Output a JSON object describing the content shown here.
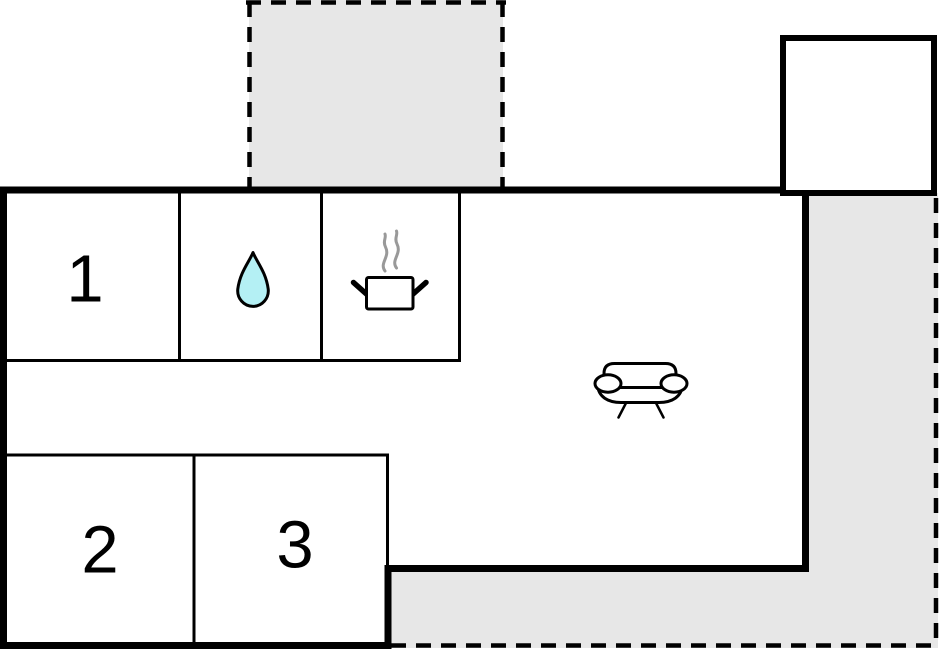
{
  "rooms": {
    "room1_label": "1",
    "room2_label": "2",
    "room3_label": "3"
  },
  "icons": [
    "water-drop-icon",
    "steam-icon",
    "cooking-pot-icon",
    "sofa-icon"
  ],
  "colors": {
    "wall": "#000000",
    "terrace_fill": "#e7e7e7",
    "water_drop": "#b4f0f4",
    "steam": "#999999",
    "background": "#ffffff"
  }
}
